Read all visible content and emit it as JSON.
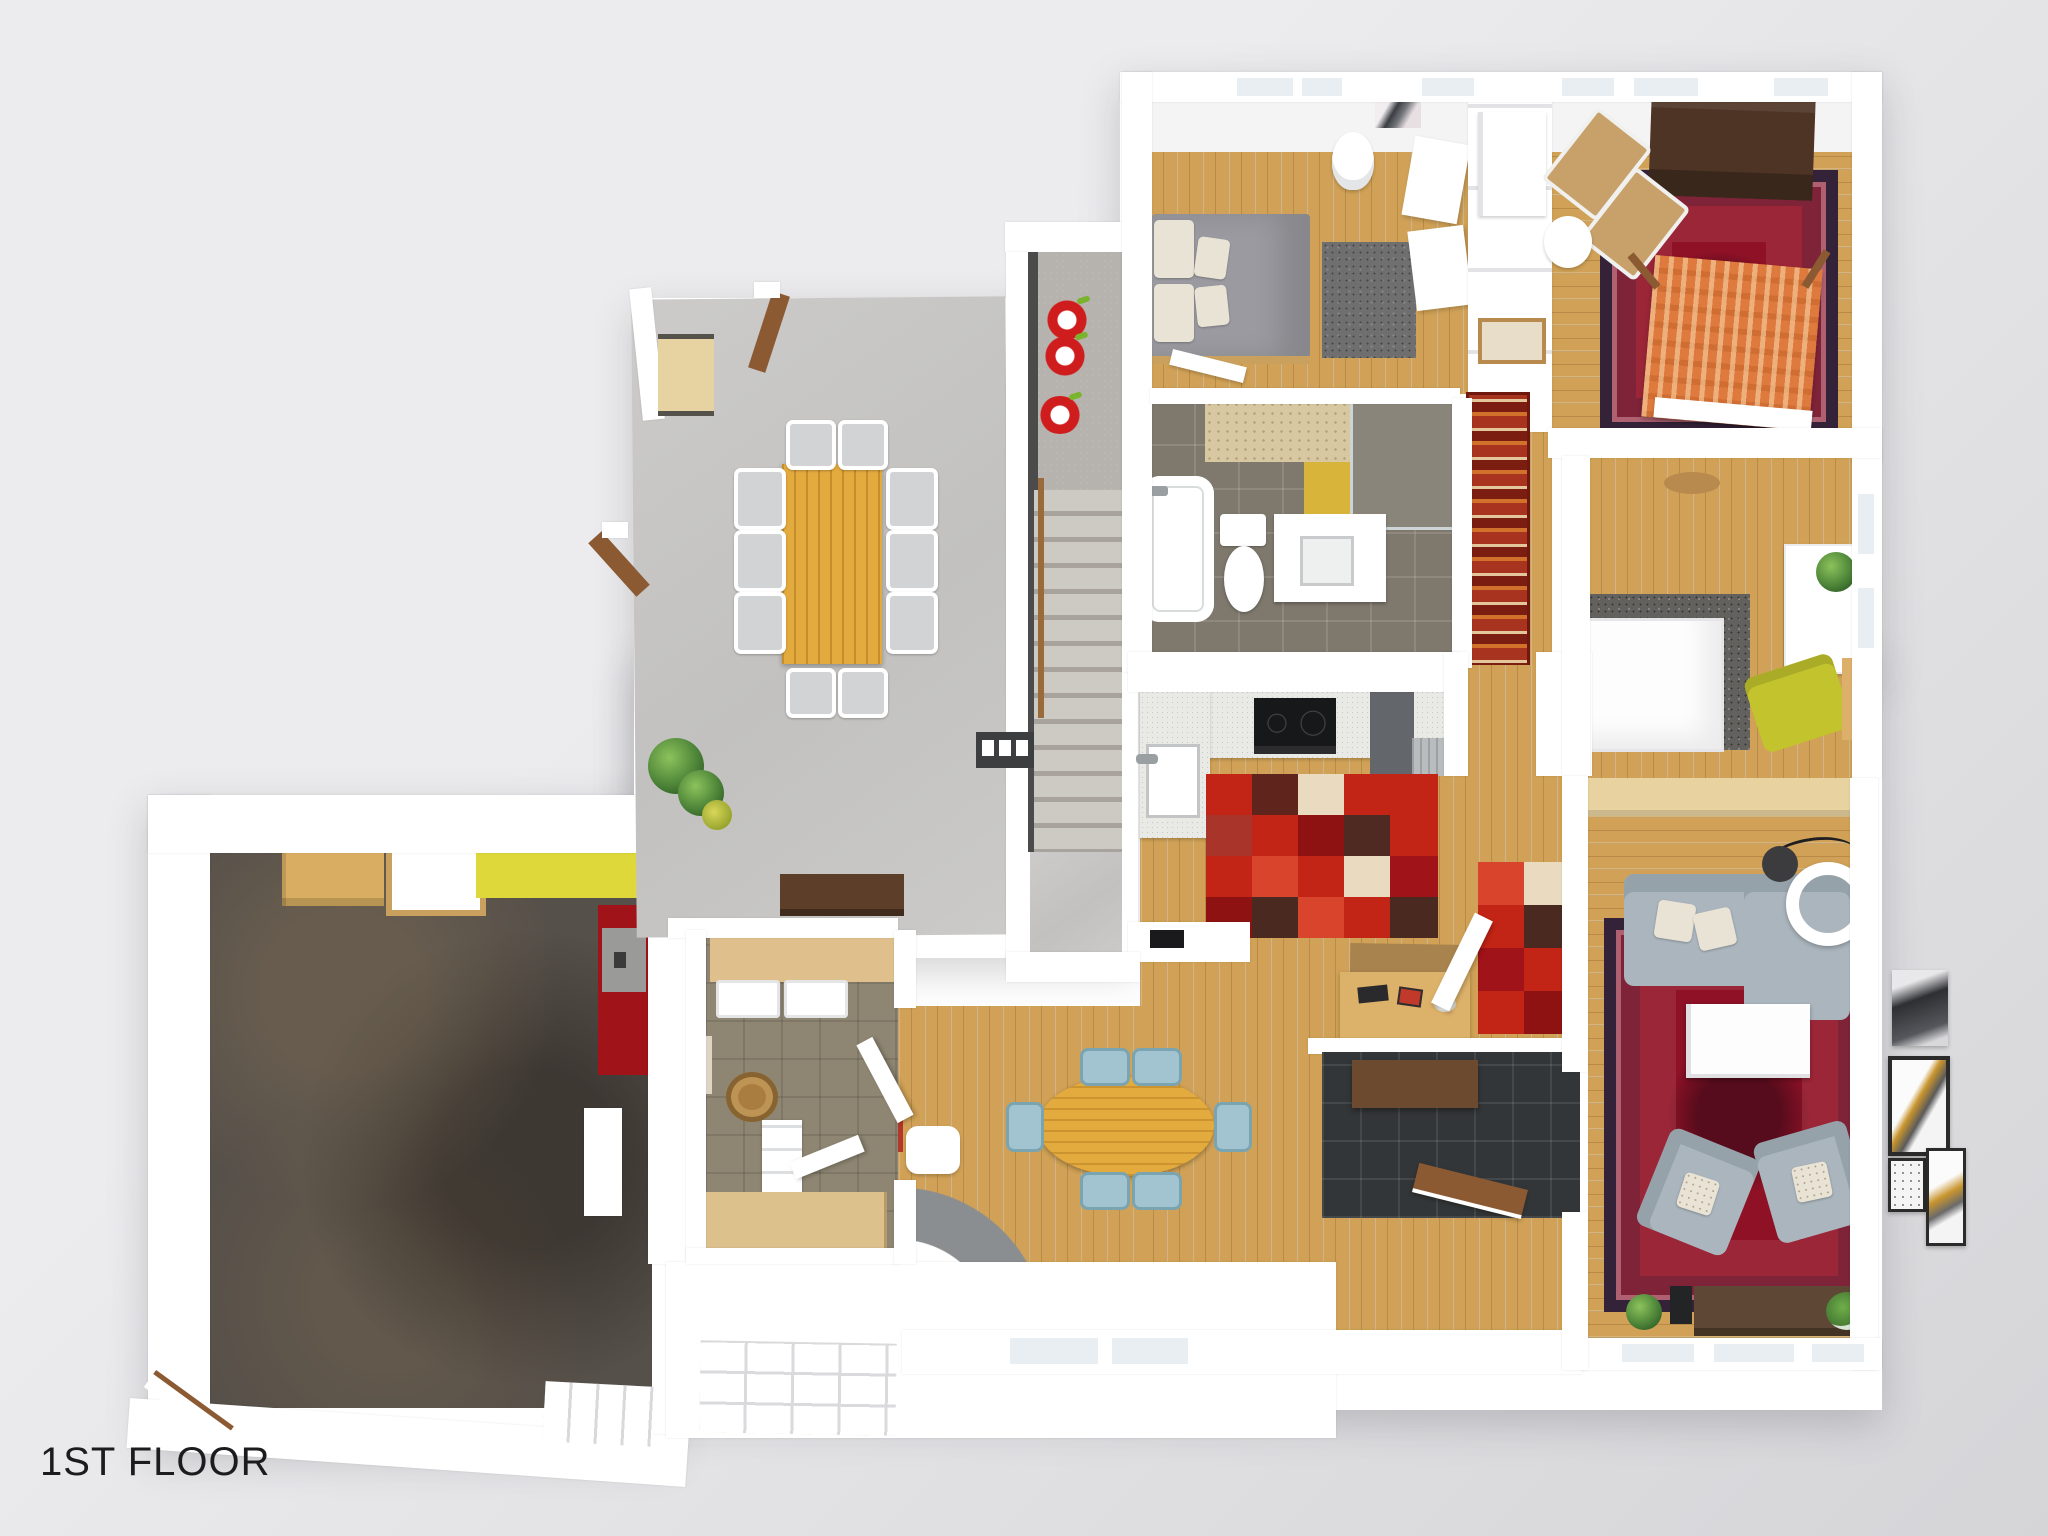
{
  "title": "1ST FLOOR",
  "scene": {
    "type": "3d-floor-plan-render",
    "floor_label": "1ST FLOOR",
    "view": "top-down dollhouse render of a single-storey home"
  },
  "palette": {
    "bg1": "#ececee",
    "bg2": "#d5d5d8",
    "wall": "#ffffff",
    "wallShade": "#f4f4f5",
    "glass": "#e9eef2",
    "wood": "#d0a156",
    "woodPale": "#e6cf9c",
    "concrete": "#c8c7c5",
    "garage": "#56504a",
    "tileGray": "#7e786d",
    "mudTile": "#8e8672",
    "genkan": "#333638",
    "landing": "#b6b3ae",
    "rugRed": "#c22415",
    "rugRed2": "#a01318",
    "rugMaroon": "#6e1d17",
    "rugBrown": "#4a2a20",
    "rugCream": "#eadbc0",
    "orientalField": "#8e1126",
    "orientalBorder": "#342238",
    "zigzagBase": "#a83420",
    "zigzagStripe": "#d1712c",
    "sofa": "#aab5bd",
    "sofaDark": "#96a2aa",
    "pillow": "#e9e3d6",
    "blueChair": "#a2c4d0",
    "tableWood": "#e3aa3e",
    "benchWood": "#5c3e29",
    "dresser": "#4e3425",
    "doorBrown": "#8b5a33",
    "yellowCounter": "#dfd83b",
    "yellowChair": "#c2c32d",
    "beige": "#dfc08d",
    "beigeTile": "#d8c8a2",
    "bedGray": "#9a9aa0",
    "rugShag": "#6f6f6f",
    "orangeBed": "#df7a3e",
    "tan": "#c8a06a",
    "apple": "#cf1d1d",
    "steel": "#b9bcbe",
    "darkUnit": "#63666a",
    "black": "#17181a",
    "label": "#1c1c1e"
  },
  "rooms": [
    {
      "id": "garage",
      "floor": "dark-concrete"
    },
    {
      "id": "dining-terrace",
      "floor": "concrete"
    },
    {
      "id": "stairwell",
      "floor": "concrete-stairs"
    },
    {
      "id": "bedroom-1",
      "floor": "wood"
    },
    {
      "id": "bedroom-2",
      "floor": "wood"
    },
    {
      "id": "bedroom-3",
      "floor": "wood"
    },
    {
      "id": "bathroom",
      "floor": "gray-tile"
    },
    {
      "id": "hallway",
      "floor": "wood-with-zigzag-runner"
    },
    {
      "id": "kitchen",
      "floor": "wood-with-patchwork-rug"
    },
    {
      "id": "breakfast-nook",
      "floor": "wood"
    },
    {
      "id": "living-room",
      "floor": "wood-with-oriental-rug"
    },
    {
      "id": "laundry-mudroom",
      "floor": "olive-tile"
    },
    {
      "id": "entry-genkan",
      "floor": "dark-tile"
    },
    {
      "id": "porch",
      "floor": "white-deck"
    }
  ]
}
